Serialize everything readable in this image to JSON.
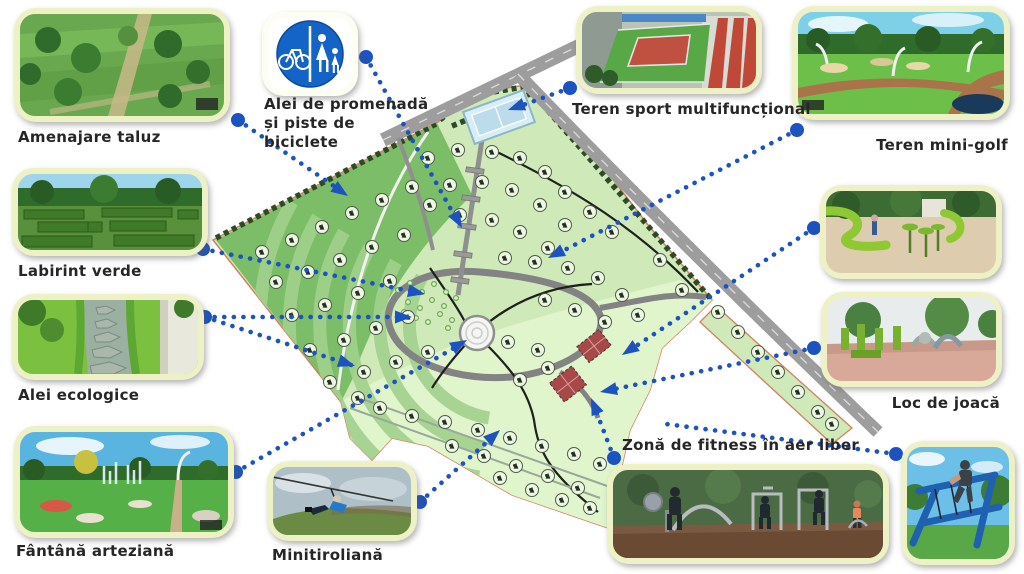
{
  "callouts": {
    "taluz": {
      "label": "Amenajare taluz"
    },
    "promenade": {
      "label_line1": "Alei de promenadă",
      "label_line2": "și piste de biciclete"
    },
    "sport": {
      "label": "Teren sport multifuncțional"
    },
    "minigolf": {
      "label": "Teren mini-golf"
    },
    "labirint": {
      "label": "Labirint verde"
    },
    "eco": {
      "label": "Alei ecologice"
    },
    "fountain": {
      "label": "Fântână arteziană"
    },
    "zipline": {
      "label": "Minitiroliană"
    },
    "playground": {
      "label": "Loc de joacă"
    },
    "fitness": {
      "label": "Zonă de fitness în aer liber"
    }
  },
  "colors": {
    "connector_blue": "#1d53c0",
    "card_border": "#eef1c6",
    "park_base_green": "#cfeab8",
    "slope_dark_green": "#7cbd68",
    "boundary_red": "#d08060",
    "road_gray": "#9d9d9d"
  }
}
